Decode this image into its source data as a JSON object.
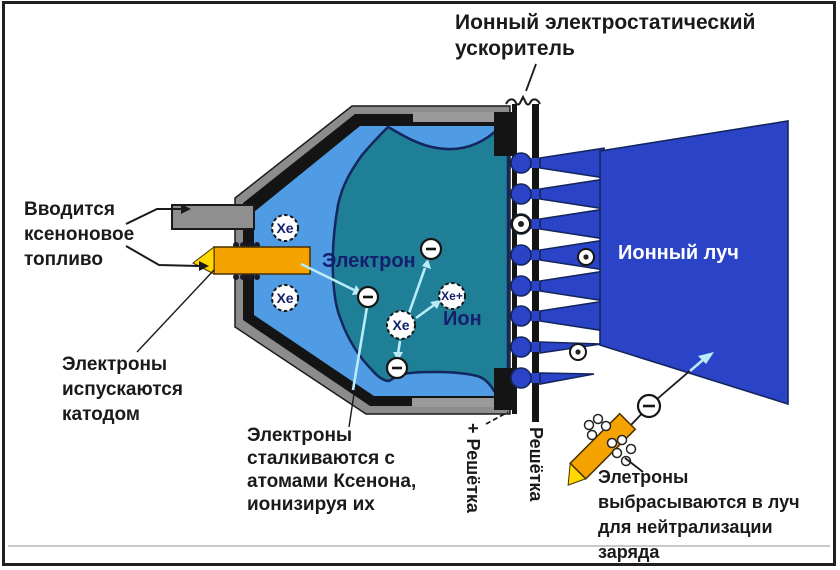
{
  "diagram": {
    "accelerator_label": "Ионный электростатический\nускоритель",
    "fuel_label": "Вводится\nксеноновое\nтопливо",
    "cathode_label": "Электроны\nиспускаются\nкатодом",
    "collision_label": "Электроны\nсталкиваются с\nатомами Ксенона,\nионизируя их",
    "neutralizer_label": "Элетроны\nвыбрасываются в луч\nдля нейтрализации\nзаряда",
    "grid_plus_label": "+ Решётка",
    "grid_minus_label": "- Решётка",
    "electron_label": "Электрон",
    "ion_label": "Ион",
    "beam_label": "Ионный луч"
  },
  "particles": {
    "xenon": "Xe",
    "xenon_ion": "Xe+"
  },
  "colors": {
    "beam_blue": "#2a43c7",
    "plasma_teal": "#1f7f97",
    "chamber_blue": "#4f9ce4",
    "outline_navy": "#13265e",
    "cathode_orange": "#f4a300",
    "cathode_tip_yellow": "#ffd900",
    "arrow_cyan": "#b9ecf8",
    "wall_gray": "#8c8c8c",
    "wall_black": "#141414",
    "label_navy": "#14206e",
    "beam_label_white": "#ffffff"
  }
}
